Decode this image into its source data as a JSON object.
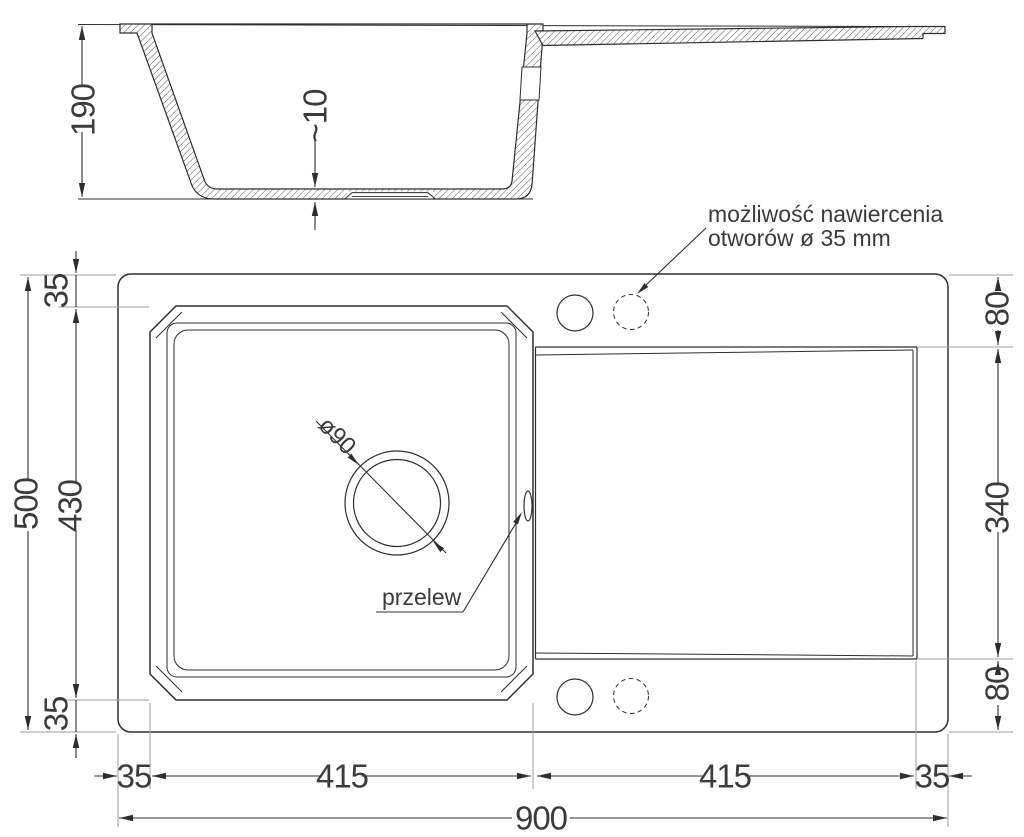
{
  "section_view": {
    "depth_dim": "190",
    "bottom_thickness_dim": "~10"
  },
  "plan_view": {
    "drill_note_line1": "możliwość nawiercenia",
    "drill_note_line2": "otworów ø 35 mm",
    "overflow_label": "przelew",
    "drain_dim": "ø90",
    "dims": {
      "left_overall": "500",
      "left_bowl": "430",
      "left_inset_top": "35",
      "left_inset_bottom": "35",
      "right_top": "80",
      "right_drainer": "340",
      "right_bottom": "80",
      "bottom_inset_left": "35",
      "bottom_bowl": "415",
      "bottom_drainer": "415",
      "bottom_inset_right": "35",
      "bottom_overall": "900"
    }
  },
  "colors": {
    "line": "#2e2e2e",
    "extension": "#9c9c9c",
    "text": "#3b3b3b",
    "background": "#ffffff"
  }
}
